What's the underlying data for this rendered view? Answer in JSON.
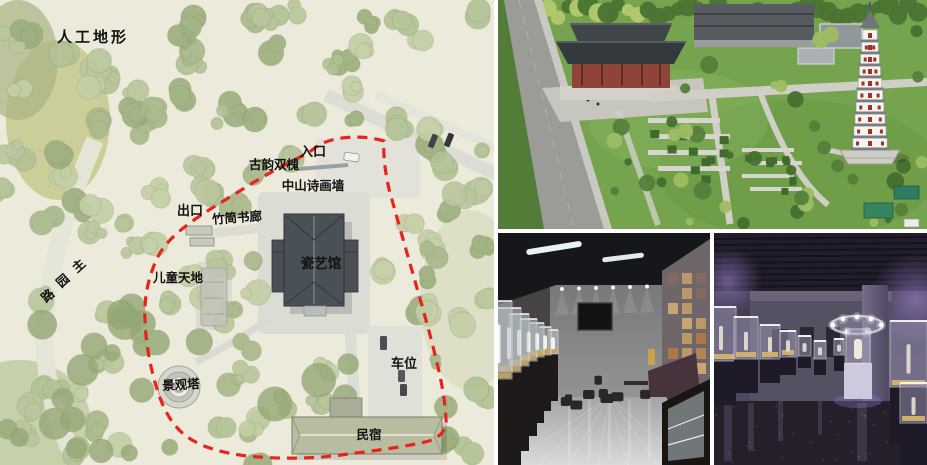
{
  "map": {
    "title": "人工地形",
    "labels": {
      "entrance": "入口",
      "twin_locusts": "古韵双槐",
      "poetry_wall": "中山诗画墙",
      "exit": "出口",
      "bamboo_gallery": "竹简书廊",
      "porcelain_hall": "瓷艺馆",
      "children_area": "儿童天地",
      "main_road": "主园路",
      "landscape_tower": "景观塔",
      "parking": "车位",
      "homestay": "民宿"
    },
    "boundary_color": "#e8231c"
  }
}
